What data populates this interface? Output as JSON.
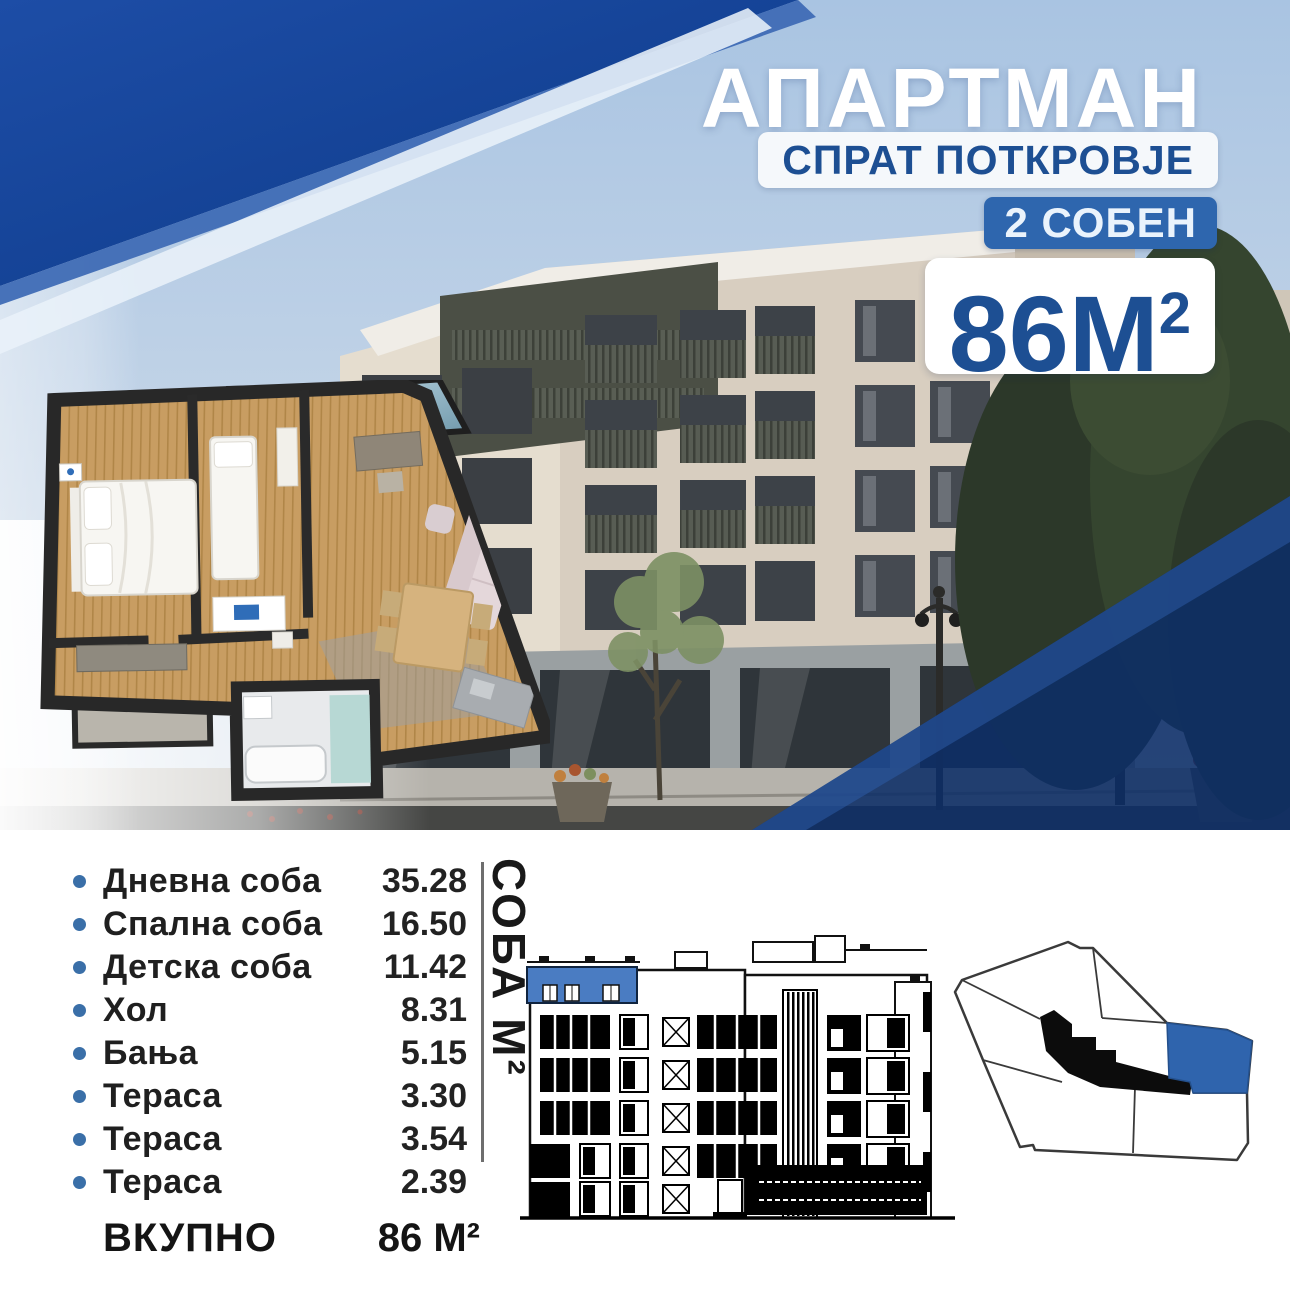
{
  "colors": {
    "accent_blue": "#1d4f93",
    "badge_blue": "#2e66ae",
    "overlay_navy": "#123f8d",
    "bullet_blue": "#3a6fa8",
    "text_dark": "#1f1f1f",
    "highlight_blue": "#2f64ad"
  },
  "header": {
    "title": "АПАРТМАН",
    "floor_label": "СПРАТ ПОТКРОВЈЕ",
    "rooms_badge": "2 СОБЕН",
    "area_value": "86М",
    "area_sup": "2"
  },
  "rooms": {
    "axis_label": "СОБА М²",
    "items": [
      {
        "label": "Дневна соба",
        "value": "35.28"
      },
      {
        "label": "Спална соба",
        "value": "16.50"
      },
      {
        "label": "Детска соба",
        "value": "11.42"
      },
      {
        "label": "Хол",
        "value": "8.31"
      },
      {
        "label": "Бања",
        "value": "5.15"
      },
      {
        "label": "Тераса",
        "value": "3.30"
      },
      {
        "label": "Тераса",
        "value": "3.54"
      },
      {
        "label": "Тераса",
        "value": "2.39"
      }
    ],
    "total_label": "ВКУПНО",
    "total_value": "86 М²"
  }
}
